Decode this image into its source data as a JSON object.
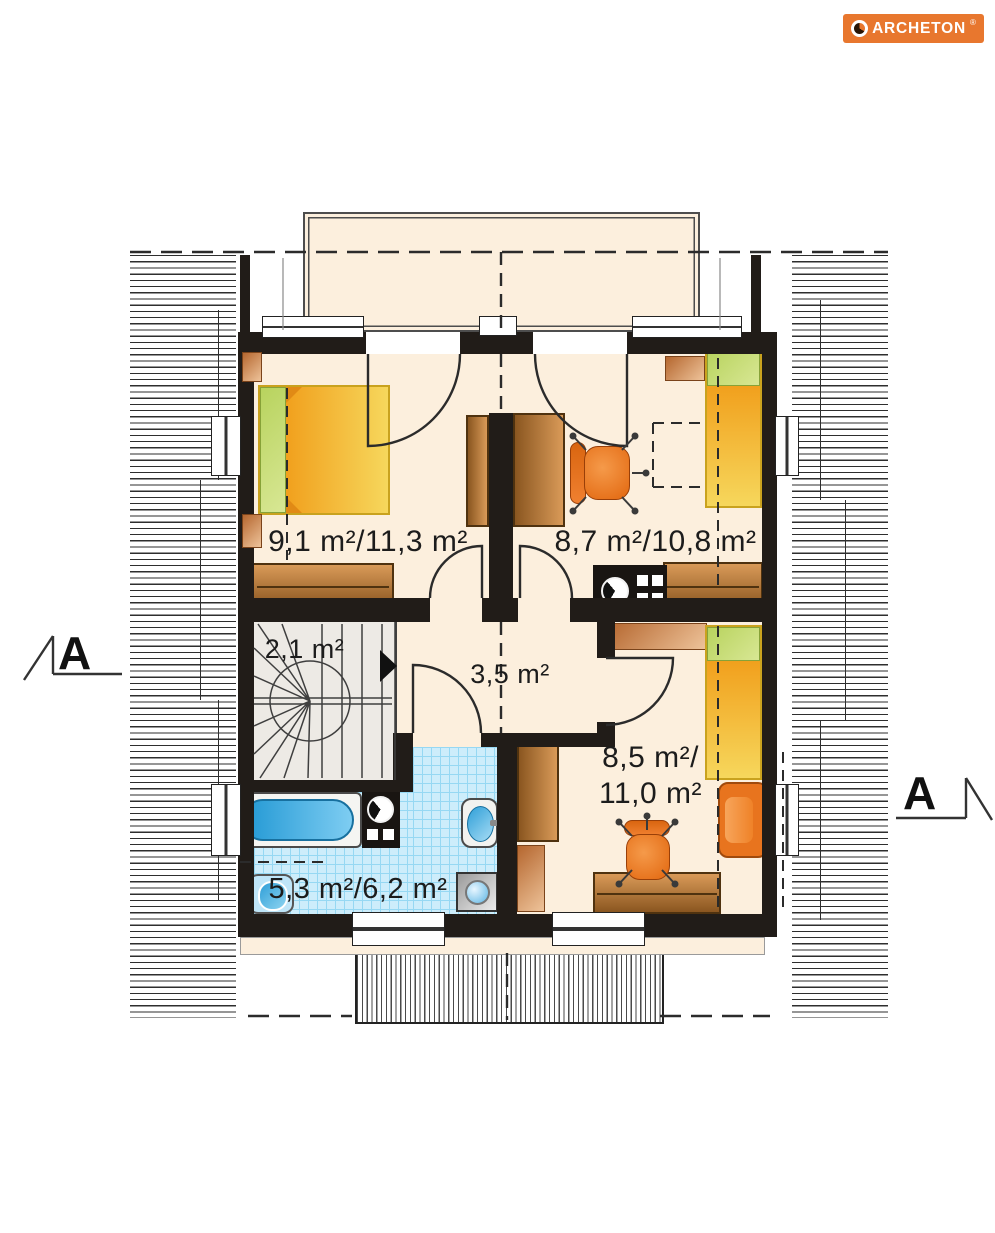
{
  "logo": {
    "brand": "ARCHETON",
    "registered": "®",
    "color": "#e8772e"
  },
  "section_markers": {
    "left": "A",
    "right": "A"
  },
  "plan": {
    "rooms": [
      {
        "id": "bedroom_left",
        "label": "9,1 m²/11,3 m²"
      },
      {
        "id": "bedroom_right",
        "label": "8,7 m²/10,8 m²"
      },
      {
        "id": "staircase",
        "label": "2,1 m²"
      },
      {
        "id": "hall",
        "label": "3,5 m²"
      },
      {
        "id": "bedroom_bottom",
        "label_line1": "8,5 m²/",
        "label_line2": "11,0 m²"
      },
      {
        "id": "bathroom",
        "label": "5,3 m²/6,2 m²"
      }
    ],
    "furniture": [
      "double-bed",
      "single-bed",
      "single-bed",
      "wardrobe",
      "wardrobe",
      "wardrobe",
      "desk",
      "desk",
      "office-chair",
      "office-chair",
      "armchair",
      "nightstand",
      "nightstand",
      "dresser",
      "dresser",
      "shelf",
      "shelf",
      "bathtub",
      "toilet",
      "toilet",
      "washbasin",
      "washing-machine",
      "winder-stairs"
    ],
    "colors": {
      "wall": "#211c18",
      "floor": "#fcefdd",
      "bathroom_tile": "#cdedfb",
      "stair": "#edeae5",
      "bed_orange": "#f1a01d",
      "bed_yellow": "#f6d75c",
      "pillow_green": "#c6dc6d",
      "furniture_brown": "#b06a2e",
      "chair_orange": "#e8751f",
      "water_blue": "#38abdf"
    }
  }
}
